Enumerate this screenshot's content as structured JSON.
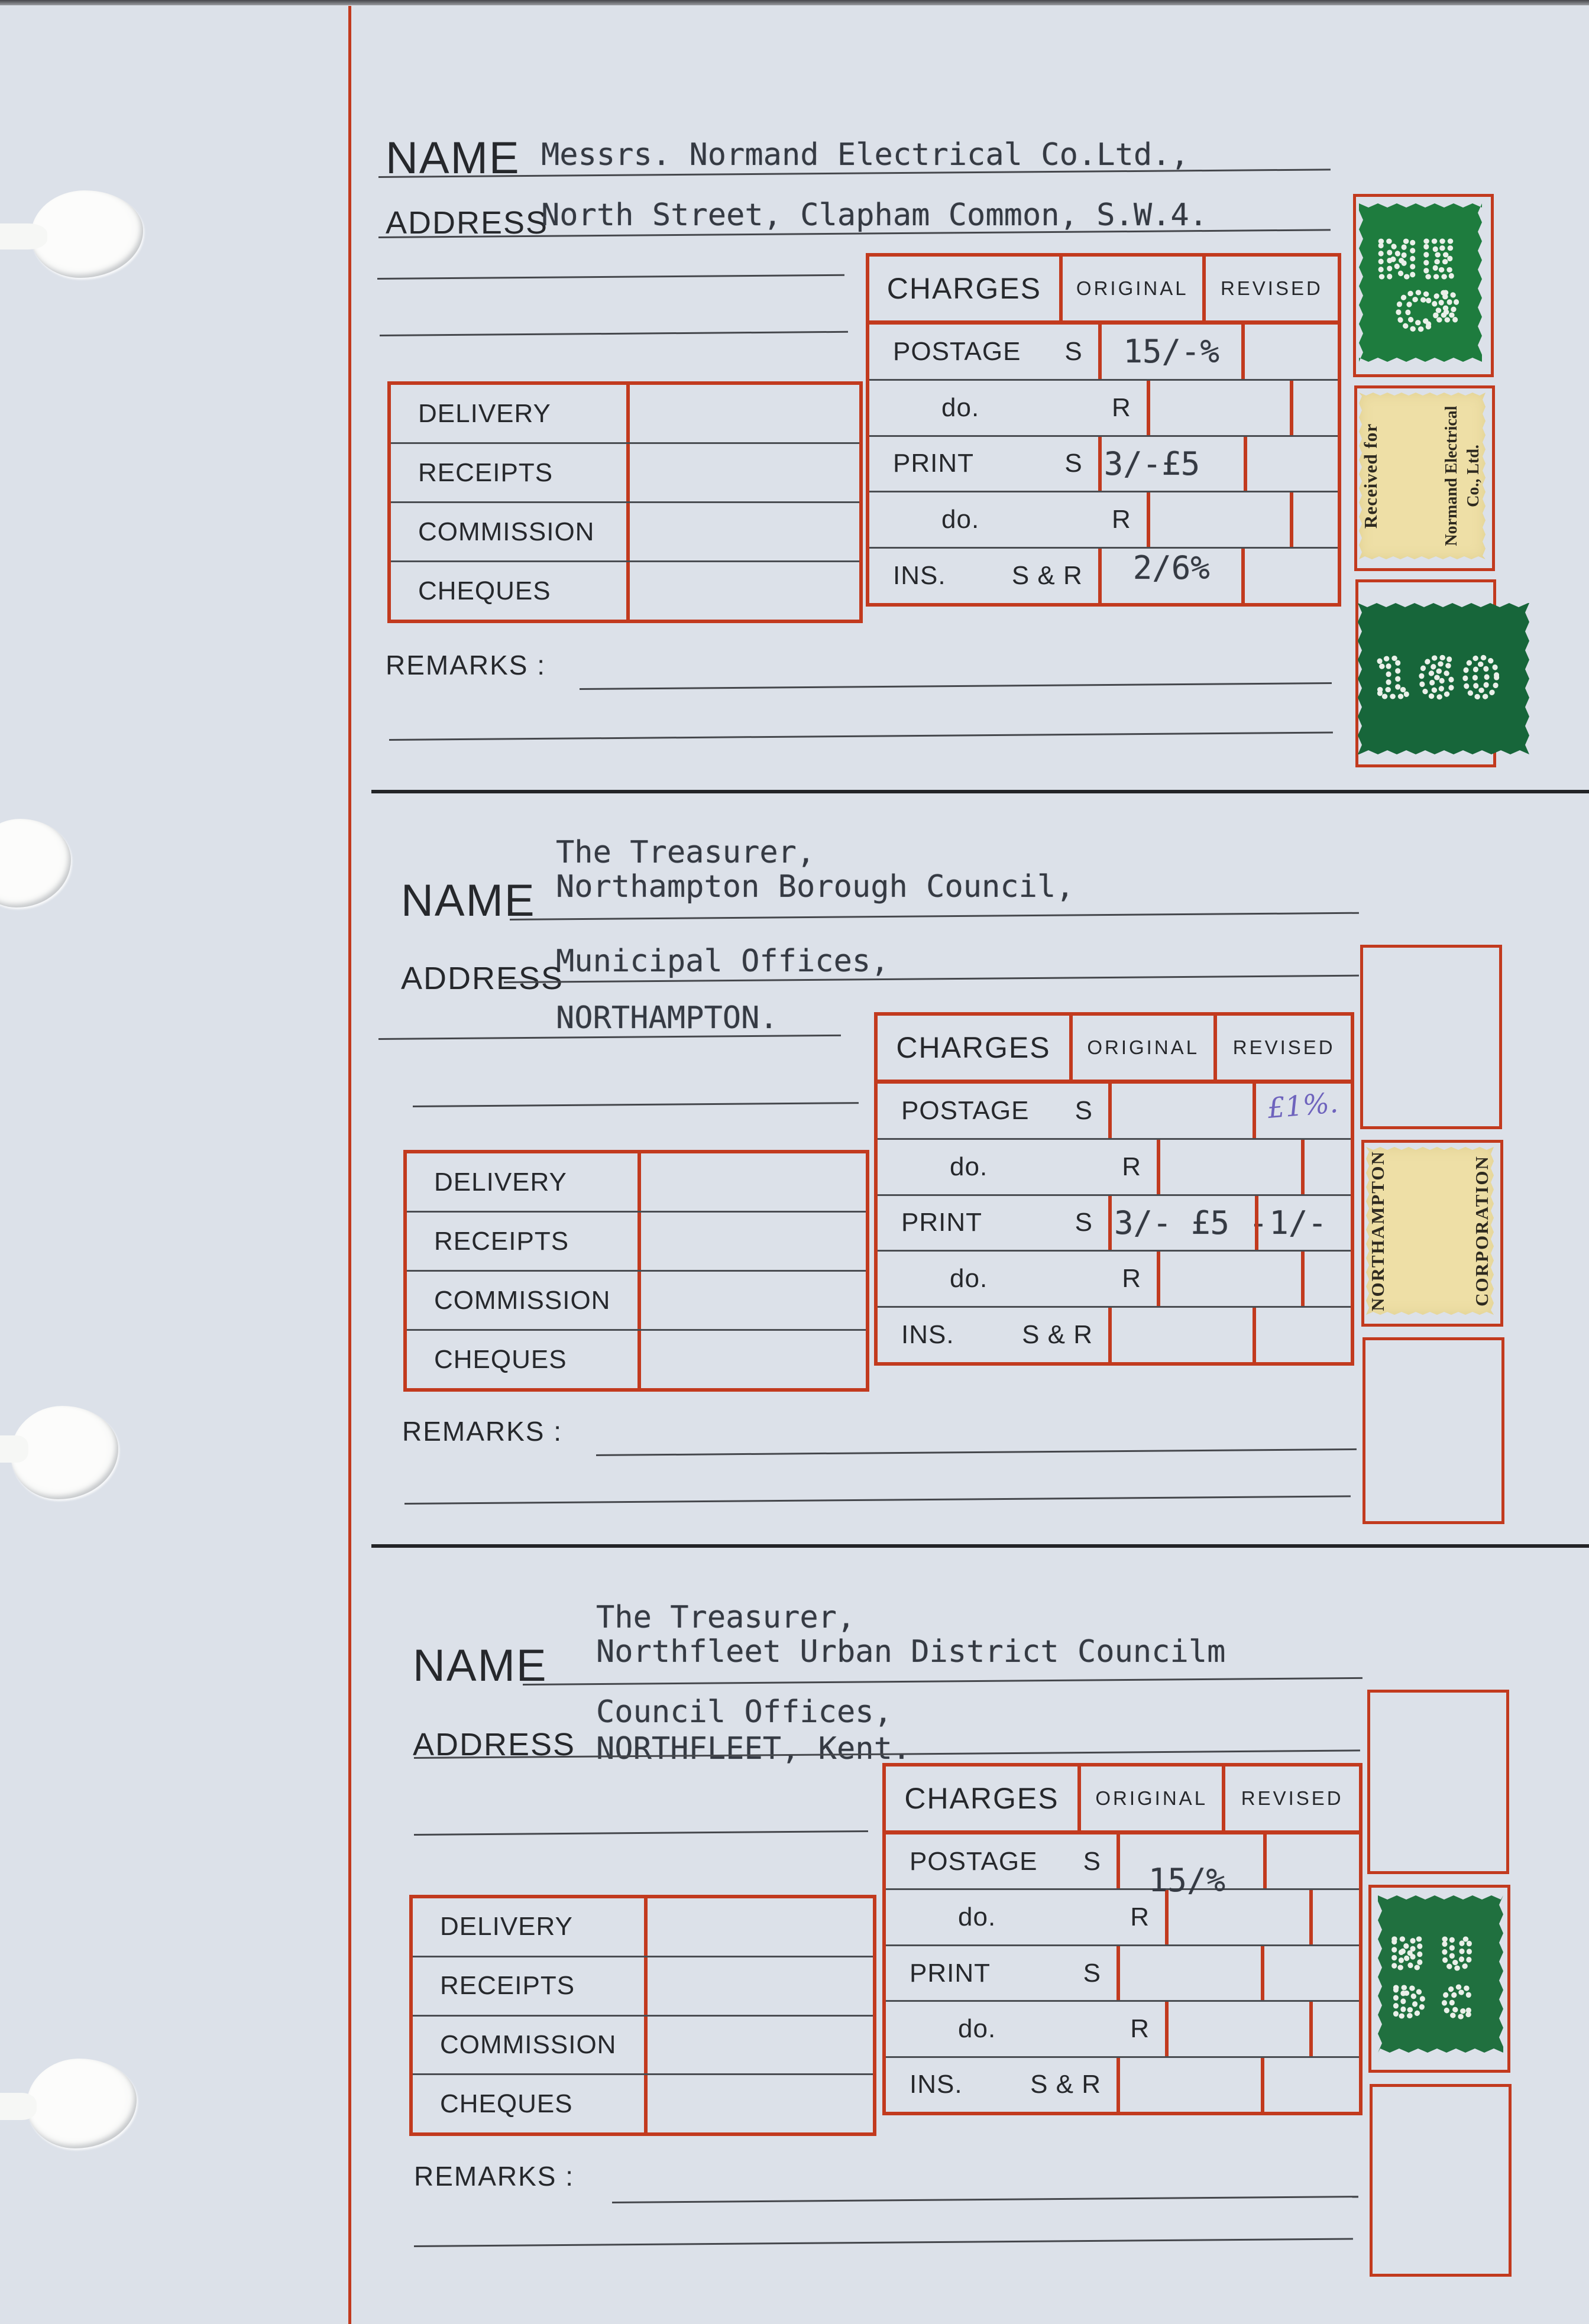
{
  "colors": {
    "form_red": "#c23a1e",
    "paper": "#dce1e9",
    "stamp_green": "#1e7c3e",
    "stamp_green_dark": "#17663a",
    "label_yellow": "#eedfa6",
    "handwriting_blue": "#6e63bd",
    "ink_black": "#26282c"
  },
  "sections": [
    {
      "name_label": "NAME",
      "address_label": "ADDRESS",
      "remarks_label": "REMARKS :",
      "name_lines": [
        "Messrs. Normand Electrical Co.Ltd.,"
      ],
      "address_lines": [
        "North Street, Clapham Common, S.W.4."
      ],
      "charges": {
        "title": "CHARGES",
        "col_original": "ORIGINAL",
        "col_revised": "REVISED",
        "rows": [
          {
            "label": "POSTAGE",
            "suffix": "S",
            "original": "15/-%",
            "revised": ""
          },
          {
            "label": "do.",
            "suffix": "R",
            "original": "",
            "revised": ""
          },
          {
            "label": "PRINT",
            "suffix": "S",
            "original": "3/-£5",
            "revised": ""
          },
          {
            "label": "do.",
            "suffix": "R",
            "original": "",
            "revised": ""
          },
          {
            "label": "INS.",
            "suffix": "S & R",
            "original": "2/6%",
            "revised": ""
          }
        ]
      },
      "ledger_rows": [
        "DELIVERY",
        "RECEIPTS",
        "COMMISSION",
        "CHEQUES"
      ],
      "stamps": {
        "green_top": {
          "perfin": [
            "NE",
            "Cº"
          ]
        },
        "yellow": {
          "top": "Received for",
          "company": [
            "Normand Electrical",
            "Co., Ltd."
          ]
        },
        "green_bottom": {
          "perfin": [
            "160"
          ]
        }
      }
    },
    {
      "name_label": "NAME",
      "address_label": "ADDRESS",
      "remarks_label": "REMARKS :",
      "name_lines": [
        "The Treasurer,",
        "Northampton Borough Council,"
      ],
      "address_lines": [
        "Municipal Offices,",
        "NORTHAMPTON."
      ],
      "charges": {
        "title": "CHARGES",
        "col_original": "ORIGINAL",
        "col_revised": "REVISED",
        "rows": [
          {
            "label": "POSTAGE",
            "suffix": "S",
            "original": "",
            "revised": "£1%."
          },
          {
            "label": "do.",
            "suffix": "R",
            "original": "",
            "revised": ""
          },
          {
            "label": "PRINT",
            "suffix": "S",
            "original": "3/- £5 -",
            "revised": "1/-"
          },
          {
            "label": "do.",
            "suffix": "R",
            "original": "",
            "revised": ""
          },
          {
            "label": "INS.",
            "suffix": "S & R",
            "original": "",
            "revised": ""
          }
        ]
      },
      "ledger_rows": [
        "DELIVERY",
        "RECEIPTS",
        "COMMISSION",
        "CHEQUES"
      ],
      "stamps": {
        "yellow": {
          "left": "NORTHAMPTON",
          "right": "CORPORATION"
        }
      }
    },
    {
      "name_label": "NAME",
      "address_label": "ADDRESS",
      "remarks_label": "REMARKS :",
      "name_lines": [
        "The Treasurer,",
        "Northfleet Urban District Councilm"
      ],
      "address_lines": [
        "Council Offices,",
        "NORTHFLEET, Kent."
      ],
      "charges": {
        "title": "CHARGES",
        "col_original": "ORIGINAL",
        "col_revised": "REVISED",
        "rows": [
          {
            "label": "POSTAGE",
            "suffix": "S",
            "original": "15/%",
            "revised": ""
          },
          {
            "label": "do.",
            "suffix": "R",
            "original": "",
            "revised": ""
          },
          {
            "label": "PRINT",
            "suffix": "S",
            "original": "",
            "revised": ""
          },
          {
            "label": "do.",
            "suffix": "R",
            "original": "",
            "revised": ""
          },
          {
            "label": "INS.",
            "suffix": "S & R",
            "original": "",
            "revised": ""
          }
        ]
      },
      "ledger_rows": [
        "DELIVERY",
        "RECEIPTS",
        "COMMISSION",
        "CHEQUES"
      ],
      "stamps": {
        "green": {
          "perfin": [
            "NU",
            "DC"
          ]
        }
      }
    }
  ]
}
